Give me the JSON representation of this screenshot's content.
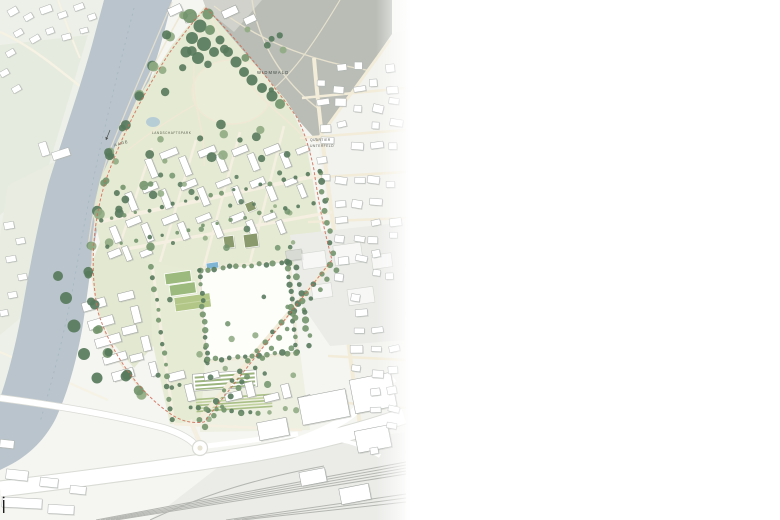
{
  "map": {
    "labels": {
      "river": "AARE",
      "forest": "WIDMWALD",
      "quarter_line1": "QUARTIER",
      "quarter_line2": "UNTERFELD",
      "park": "LANDSCHAFTSPARK"
    },
    "colors": {
      "base": "#f5f5f1",
      "west_bg": "#edf0e8",
      "field": "#e6ebdf",
      "river": "#b9c4cc",
      "river_line": "#9fb0bc",
      "site_green": "#e5ead3",
      "lawn": "#eaeed9",
      "pond": "#b7cdd6",
      "forest": "#b9bdb6",
      "forest_light": "#d4d6cf",
      "resid_bg": "#f2f2ee",
      "road_cream": "#f2ecd9",
      "road_white": "#ffffff",
      "road_casing": "#d9dbd5",
      "tree_dark": "#57795c",
      "tree_mid": "#73956d",
      "tree_light": "#90ab83",
      "building_fill": "#ffffff",
      "building_stroke": "#9ba09c",
      "shadow": "#b9bdb7",
      "boundary": "#cf6a54",
      "pool": "#7fb4d4",
      "court": "#9cba7e",
      "sport_lawn": "#b2c687",
      "olive_roof": "#8a9a6d",
      "industrial": "#ebece8",
      "rail": "#b4b6b1",
      "label": "#4b4f49"
    }
  }
}
